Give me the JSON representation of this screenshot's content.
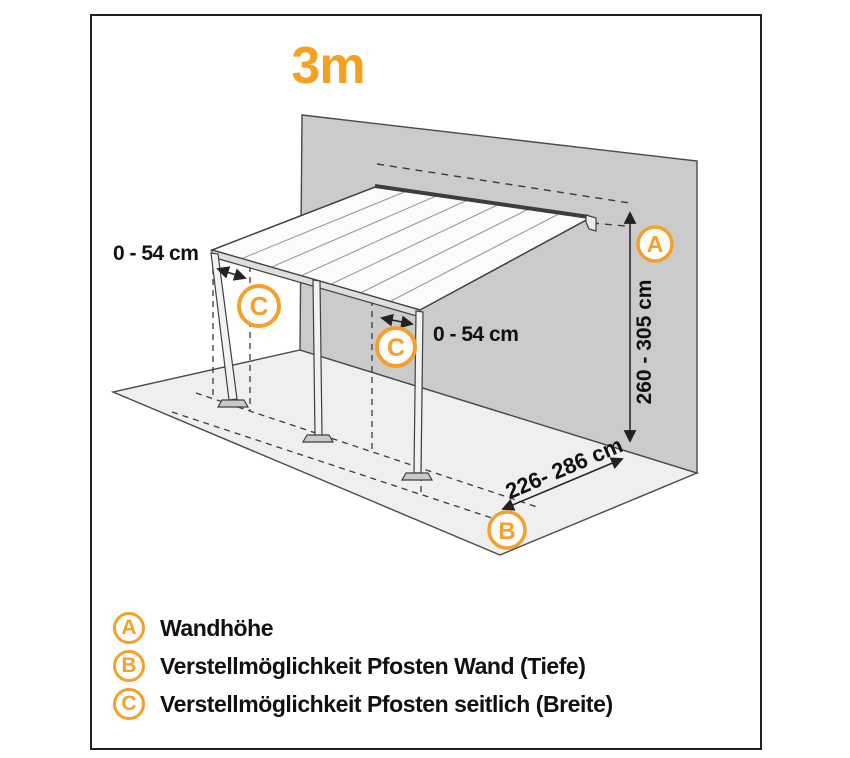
{
  "title": "3m",
  "colors": {
    "accent_orange": "#F5A01E",
    "wall_gray": "#CBCBCB",
    "floor_gray": "#EFEFEF",
    "line_dark": "#3C3C3C"
  },
  "diagram": {
    "badges": {
      "a": "A",
      "b": "B",
      "c": "C"
    },
    "dimensions": {
      "wall_height": "260 - 305 cm",
      "post_wall_depth": "226- 286 cm",
      "post_side_left": "0 - 54 cm",
      "post_side_right": "0 - 54 cm"
    }
  },
  "legend": {
    "items": [
      {
        "key": "A",
        "label": "Wandhöhe"
      },
      {
        "key": "B",
        "label": "Verstellmöglichkeit Pfosten Wand (Tiefe)"
      },
      {
        "key": "C",
        "label": "Verstellmöglichkeit Pfosten seitlich (Breite)"
      }
    ]
  }
}
